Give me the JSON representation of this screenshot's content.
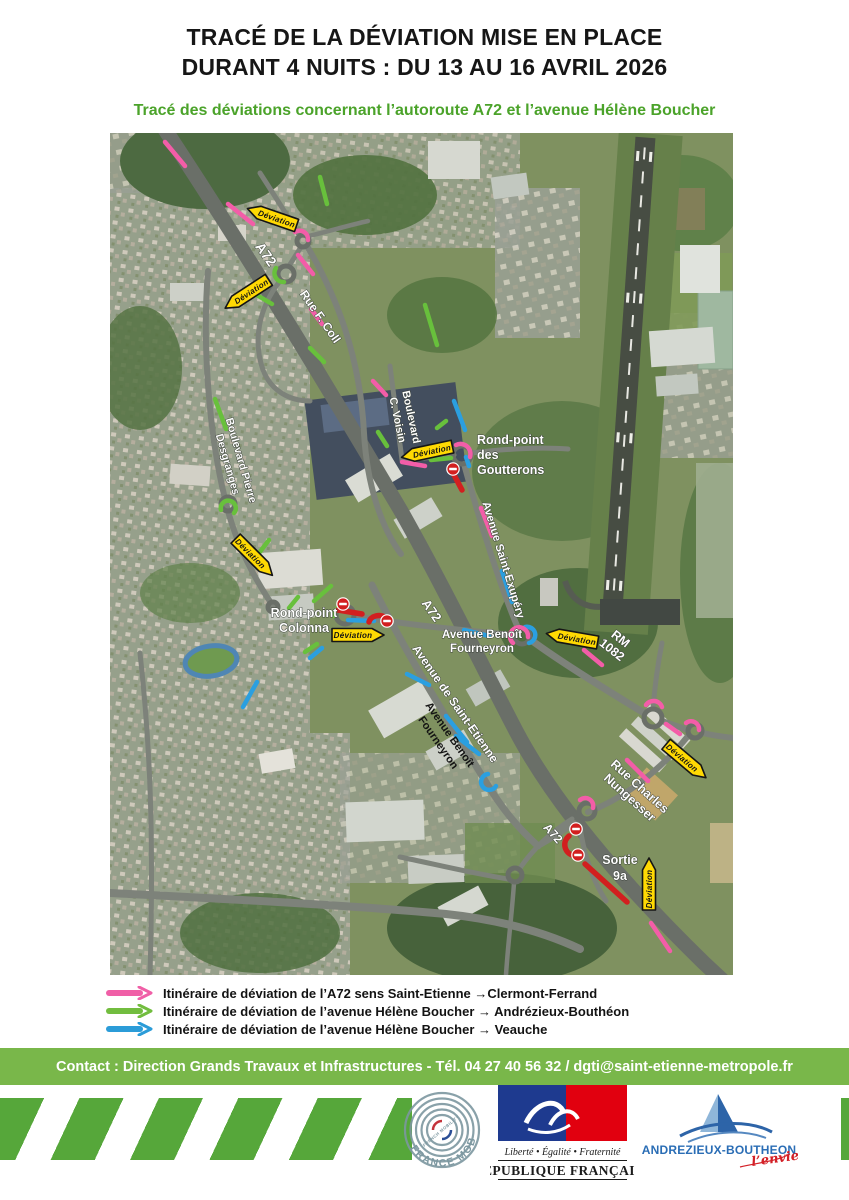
{
  "header": {
    "title_line1": "TRACÉ DE LA DÉVIATION MISE EN PLACE",
    "title_line2": "DURANT 4 NUITS : DU 13 AU 16 AVRIL 2026",
    "subtitle": "Tracé des déviations concernant l’autoroute A72 et l’avenue Hélène Boucher"
  },
  "map": {
    "deviation_label": "Déviation",
    "labels": {
      "a72": "A72",
      "rue_f_coll": "Rue F. Coll",
      "blvd_pierre_l1": "Boulevard Pierre",
      "blvd_pierre_l2": "Desgranges",
      "blvd_voisin_l1": "Boulevard",
      "blvd_voisin_l2": "C. Voisin",
      "goutterons_l1": "Rond-point",
      "goutterons_l2": "des",
      "goutterons_l3": "Goutterons",
      "exupery": "Avenue Saint-Exupéry",
      "colonna_l1": "Rond-point",
      "colonna_l2": "Colonna",
      "fourneyron_l1": "Avenue Benoît",
      "fourneyron_l2": "Fourneyron",
      "st_etienne": "Avenue de Saint-Etienne",
      "rm_l1": "RM",
      "rm_l2": "1082",
      "nungesser_l1": "Rue Charles",
      "nungesser_l2": "Nungesser",
      "sortie_l1": "Sortie",
      "sortie_l2": "9a"
    }
  },
  "legend": {
    "items": [
      {
        "color": "#f05fa7",
        "text": "Itinéraire de déviation de l’A72 sens Saint-Etienne →Clermont-Ferrand"
      },
      {
        "color": "#72bd3f",
        "text": "Itinéraire de déviation de l’avenue Hélène Boucher → Andrézieux-Bouthéon"
      },
      {
        "color": "#2b9cd8",
        "text": "Itinéraire de déviation de l’avenue Hélène Boucher → Veauche"
      }
    ]
  },
  "contact": {
    "text": "Contact : Direction Grands Travaux et Infrastructures - Tél. 04 27 40 56 32 / dgti@saint-etienne-metropole.fr"
  },
  "footer": {
    "france_mobilites": {
      "name": "FRANCE MOBILITÉS",
      "subname": "FRENCH MOBILITY"
    },
    "republique": {
      "motto": "Liberté • Égalité • Fraternité",
      "name": "RÉPUBLIQUE FRANÇAISE"
    },
    "andrezieux": {
      "name": "ANDREZIEUX-BOUTHEON",
      "tagline": "l’envie"
    }
  },
  "colors": {
    "title_text": "#161616",
    "subtitle_green": "#4ba32a",
    "deviation_pink": "#f35da8",
    "deviation_green": "#68c03c",
    "deviation_blue": "#2b9fe0",
    "deviation_sign_yellow": "#ffd903",
    "closure_red": "#d21f1f",
    "contact_bar_green": "#79b74a",
    "footer_stripe_green": "#56a73a"
  }
}
